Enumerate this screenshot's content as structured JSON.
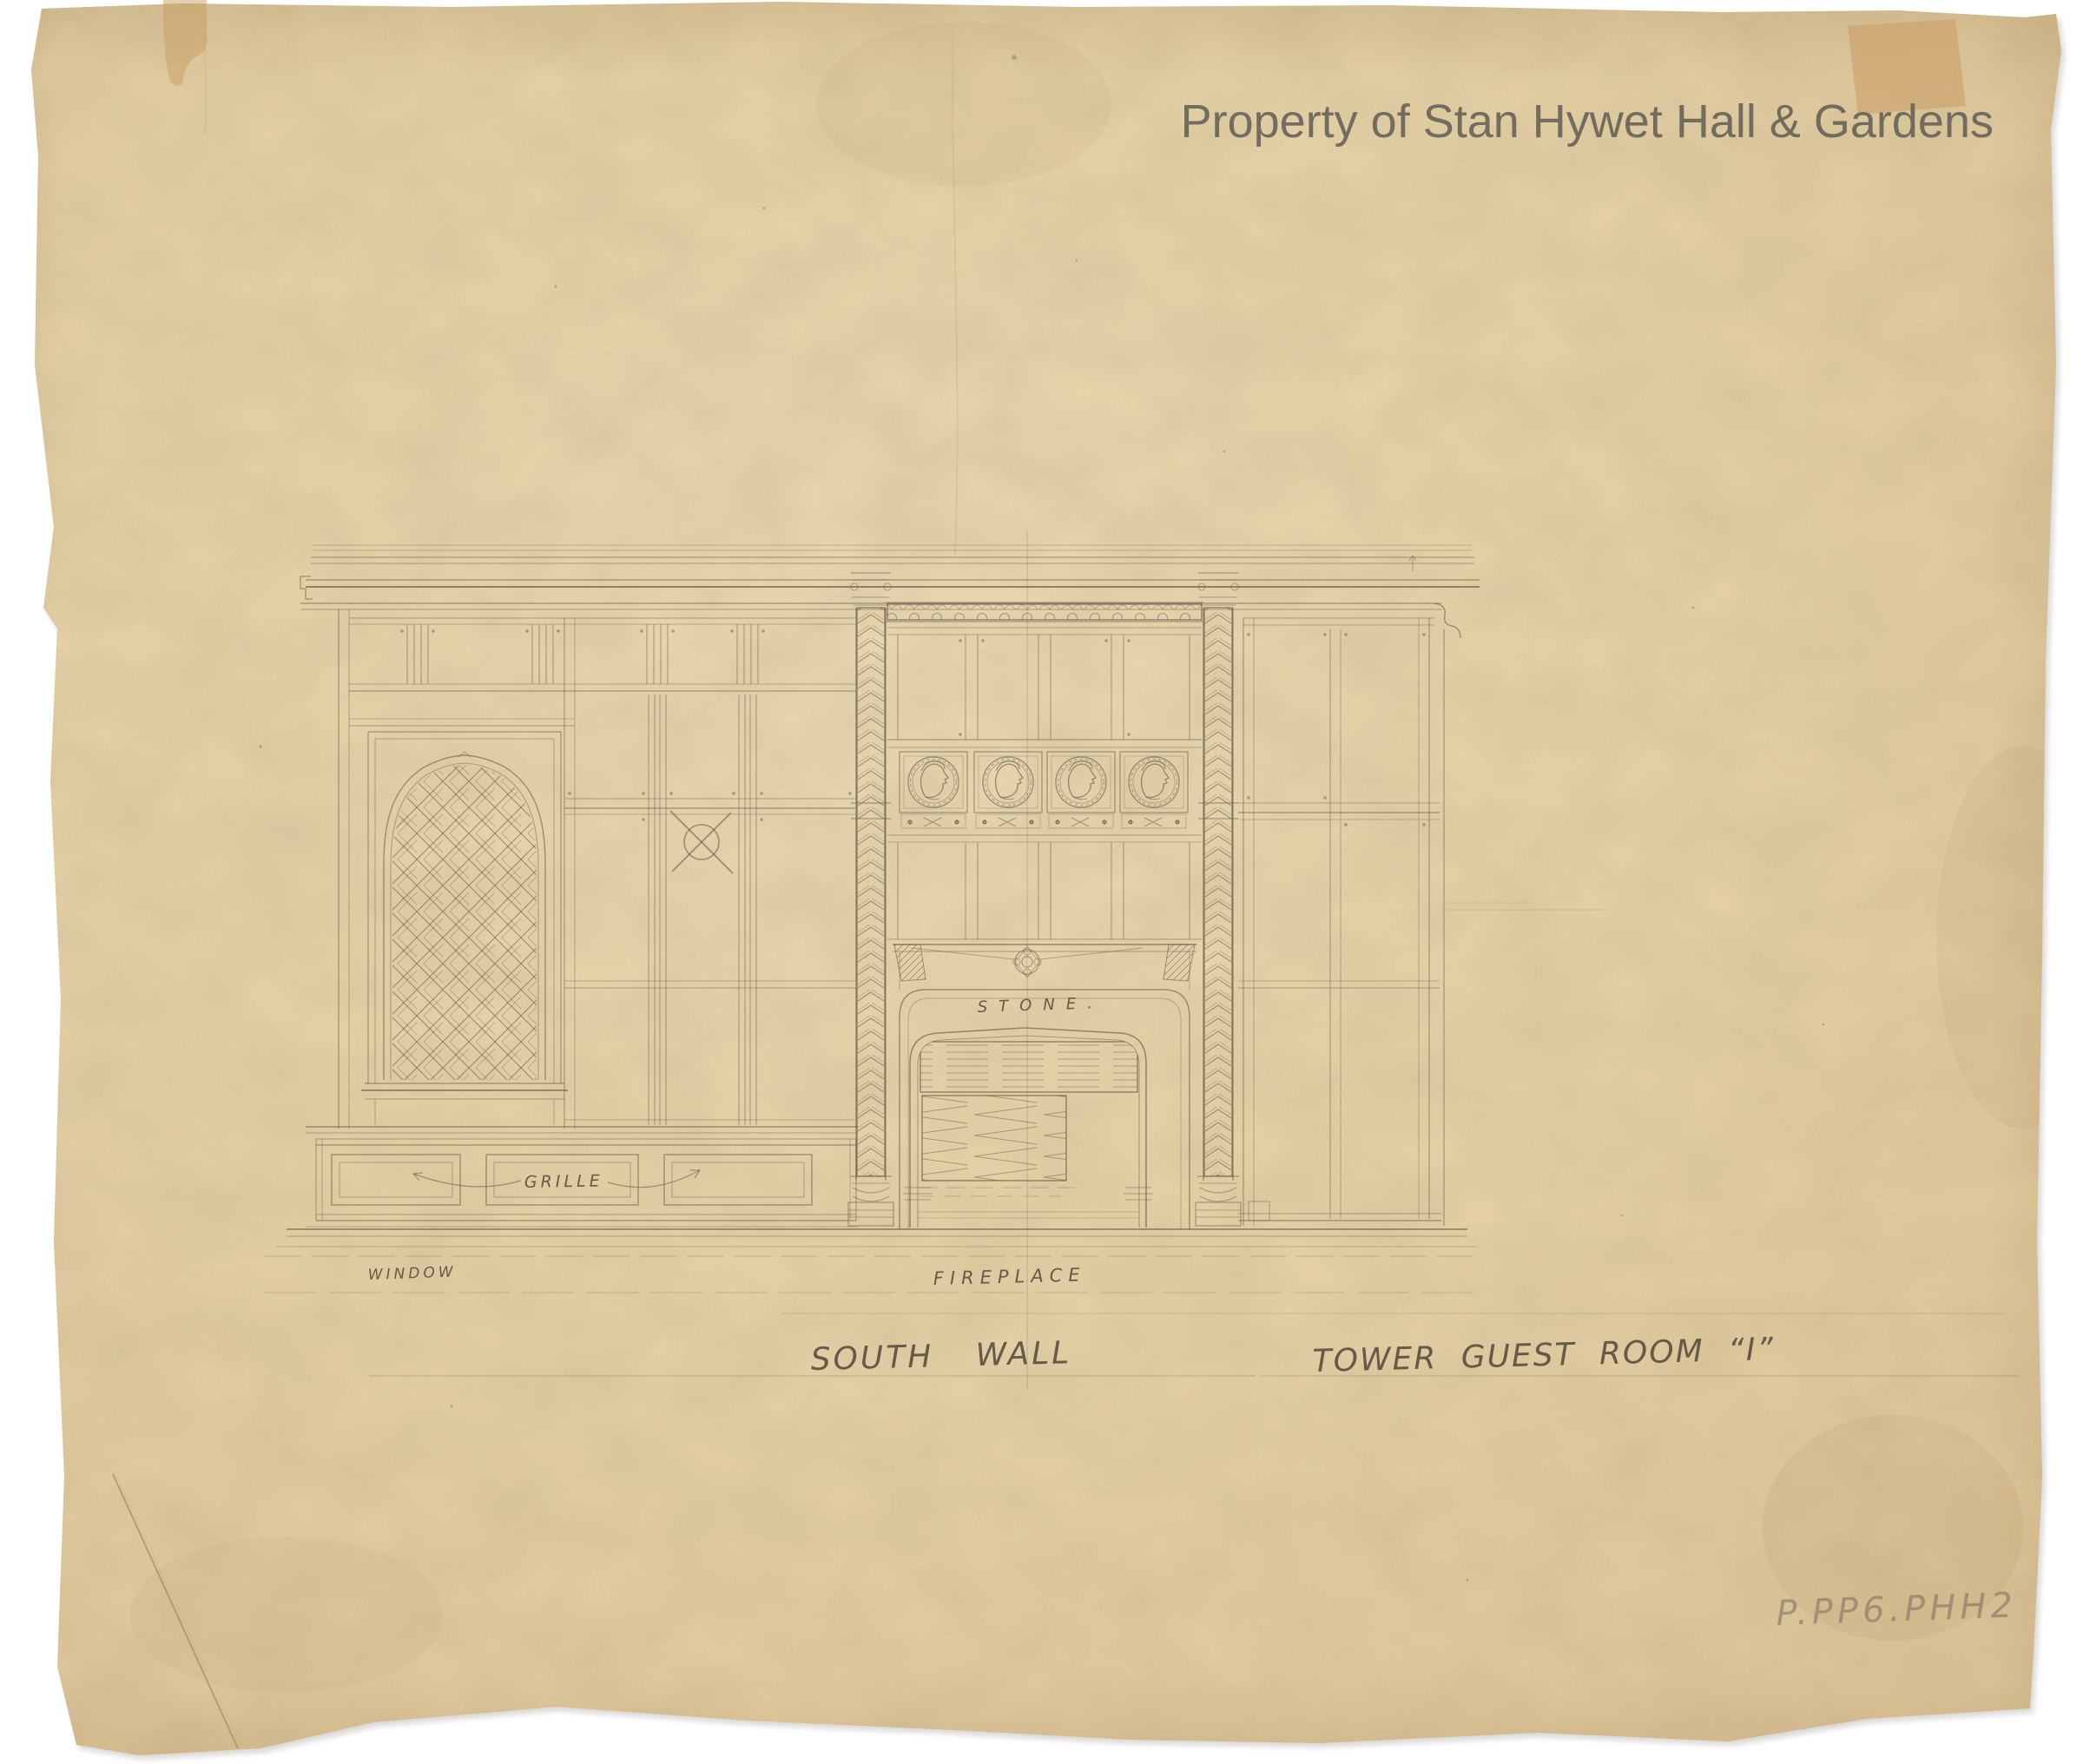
{
  "page": {
    "background": "#ffffff"
  },
  "paper": {
    "fill": "#ebd7ac",
    "edge_fill": "#dfc697",
    "tape_color": "#c99e66",
    "pencil_color": "#6b604c"
  },
  "watermark": {
    "text": "Property of Stan Hywet Hall & Gardens",
    "color": "#6a665b"
  },
  "labels": {
    "window": "WINDOW",
    "fireplace": "FIREPLACE",
    "grille": "GRILLE",
    "stone": "STONE.",
    "south_wall": "SOUTH WALL",
    "room": "TOWER GUEST ROOM “I”",
    "catalog_number": "P.PP6.PHH2"
  }
}
